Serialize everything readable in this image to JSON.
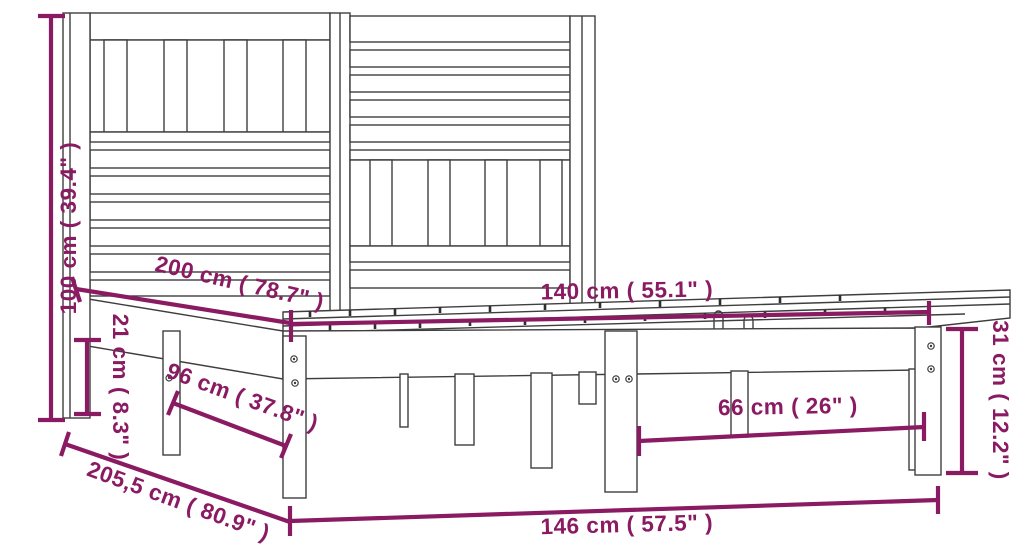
{
  "page": {
    "type": "product-dimension-diagram",
    "subject": "wooden slatted bed frame with headboard",
    "background": "#ffffff"
  },
  "colors": {
    "dimension_annotation": "#8a1a62",
    "line_art": "#3e3e3e"
  },
  "dimensions": {
    "headboard_height": "100 cm ( 39.4\" )",
    "mattress_length": "200 cm ( 78.7\" )",
    "mattress_width": "140 cm ( 55.1\" )",
    "rail_height": "21 cm ( 8.3\" )",
    "side_leg_spacing": "96 cm ( 37.8\" )",
    "front_leg_spacing": "66 cm ( 26\" )",
    "frame_height": "31 cm ( 12.2\" )",
    "total_length": "205,5 cm ( 80.9\" )",
    "total_width": "146 cm ( 57.5\" )"
  }
}
